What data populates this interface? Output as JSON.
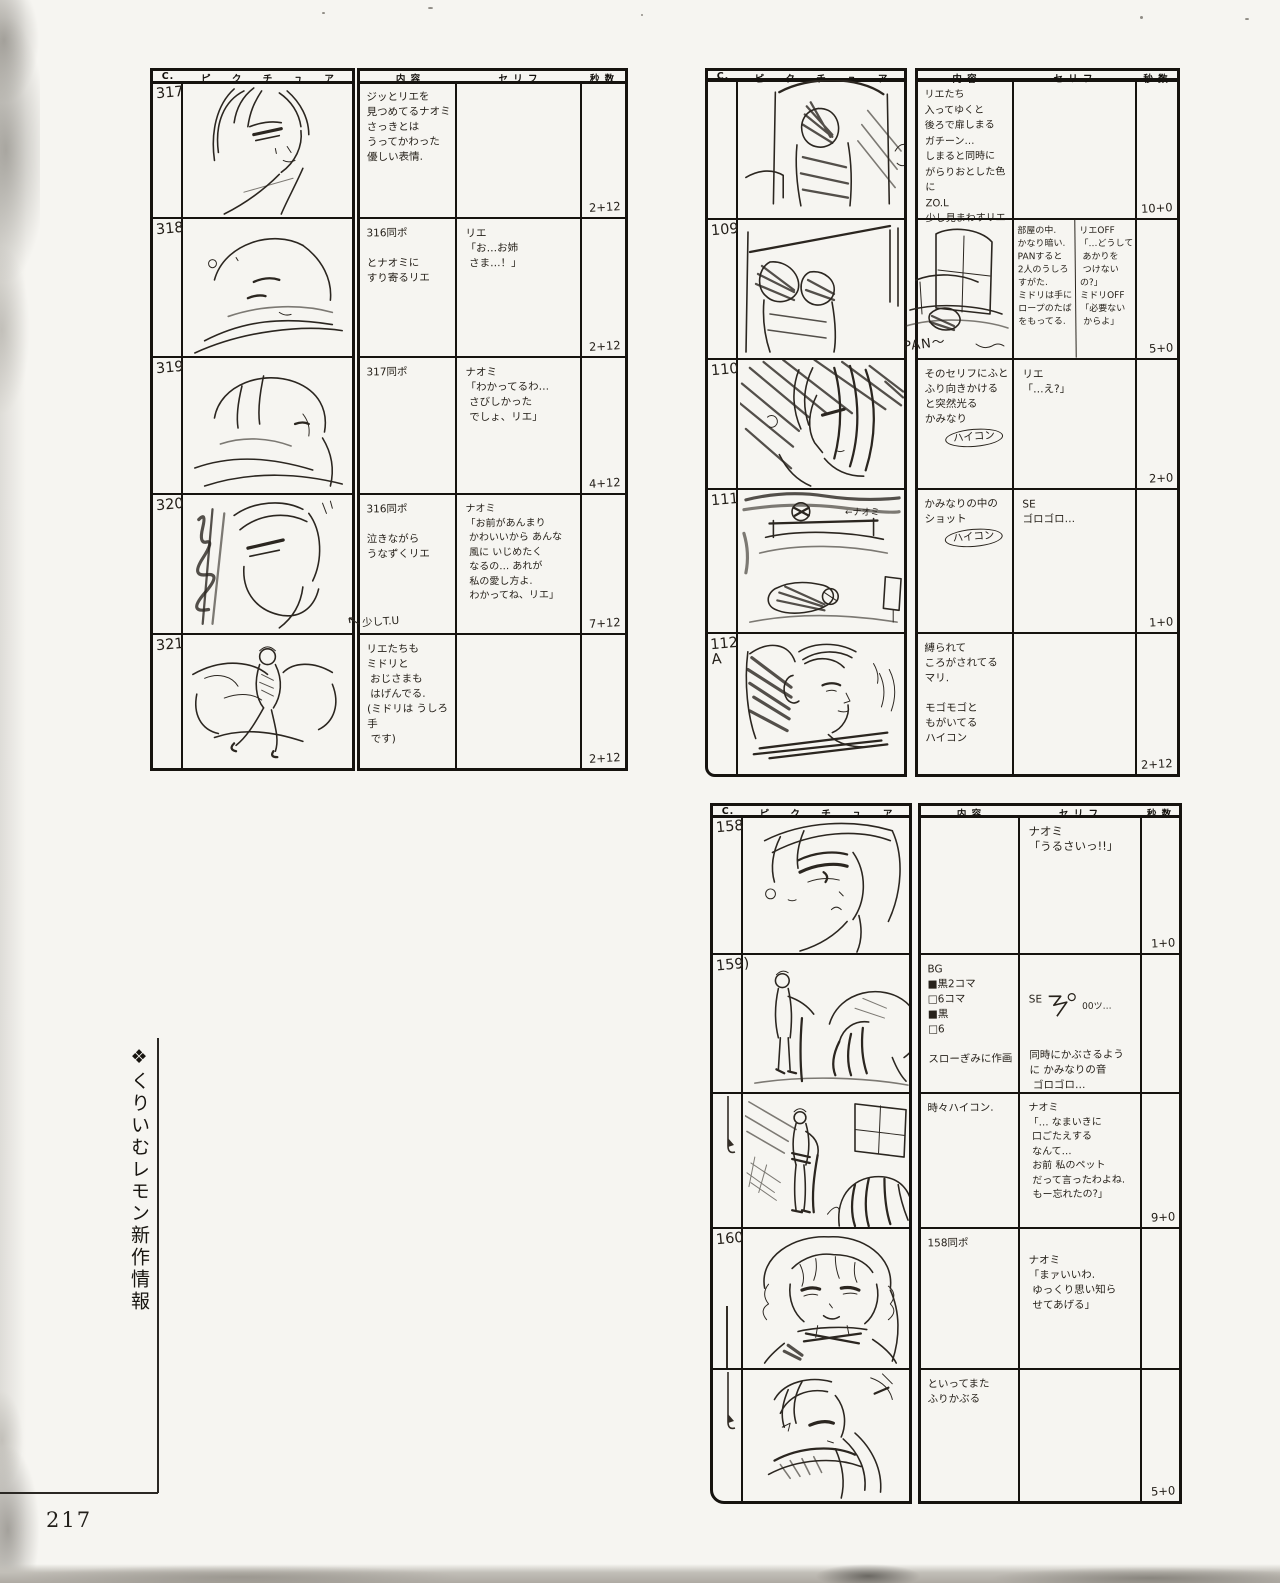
{
  "page": {
    "number": "217",
    "side_caption": "❖くりいむレモン新作情報"
  },
  "form": {
    "headers": {
      "cut": "C.",
      "picture": "ピ ク チ ュ ア",
      "content": "内  容",
      "dialogue": "セ リ フ",
      "seconds": "秒 数"
    }
  },
  "tables": [
    {
      "rows": [
        {
          "cut": "317",
          "content": "ジッとリエを\n見つめてるナオミ\nさっきとは\nうってかわった\n優しい表情.",
          "dialogue": "",
          "seconds": "2+12"
        },
        {
          "cut": "318",
          "content": "316同ポ\n\nとナオミに\nすり寄るリエ",
          "dialogue": "リエ\n「お…お姉\n さま…！」",
          "seconds": "2+12"
        },
        {
          "cut": "319",
          "content": "317同ポ",
          "dialogue": "ナオミ\n「わかってるわ…\n さびしかった\n でしょ、リエ」",
          "seconds": "4+12"
        },
        {
          "cut": "320",
          "content": "316同ポ\n\n泣きながら\nうなずくリエ",
          "note": "少しT.U",
          "dialogue": "ナオミ\n「お前があんまり\n かわいいから あんな\n 風に いじめたく\n なるの… あれが\n 私の愛し方よ.\n わかってね、リエ」",
          "seconds": "7+12"
        },
        {
          "cut": "321",
          "content": "リエたちも\nミドリと\n おじさまも\n はげんでる.\n(ミドリは うしろ手\n です)",
          "dialogue": "",
          "seconds": "2+12"
        }
      ]
    },
    {
      "rows": [
        {
          "cut": "",
          "content": "リエたち\n入ってゆくと\n後ろで扉しまる\nガチーン…\nしまると同時に\nがらりおとした色に\nZO.L\n少し見まわすリエ",
          "dialogue": "",
          "seconds": "10+0"
        },
        {
          "cut": "109",
          "content": "部屋の中.\nかなり暗い.\nPANすると\n2人のうしろ\nすがた.\nミドリは手に\nロープのたば\nをもってる.",
          "pan_label": "PAN〜",
          "dialogue": "リエOFF\n「…どうして\n あかりを\n つけないの?」\nミドリOFF\n「必要ない\n からよ」",
          "seconds": "5+0"
        },
        {
          "cut": "110",
          "content": "そのセリフにふと\nふり向きかける\nと突然光る\nかみなり",
          "circled": "ハイコン",
          "dialogue": "リエ\n「…え?」",
          "seconds": "2+0"
        },
        {
          "cut": "111",
          "content": "かみなりの中の\nショット",
          "circled": "ハイコン",
          "picture_note": "←ナオミ",
          "dialogue": "SE\nゴロゴロ…",
          "seconds": "1+0"
        },
        {
          "cut": "112\nA",
          "content": "縛られて\nころがされてる\nマリ.\n\nモゴモゴと\nもがいてる\nハイコン",
          "dialogue": "",
          "seconds": "2+12"
        }
      ]
    },
    {
      "rows": [
        {
          "cut": "158",
          "content": "",
          "dialogue": "ナオミ\n「うるさいっ!!」",
          "seconds": "1+0"
        },
        {
          "cut": "159)",
          "content": "BG\n■黒2コマ\n□6コマ\n■黒\n□6\n\nスローぎみに作画",
          "se_label": "SE",
          "se_note": "00ツ…",
          "dialogue": "同時にかぶさるよう\nに かみなりの音\n ゴロゴロ…",
          "seconds": ""
        },
        {
          "cut": "",
          "content": "時々ハイコン.",
          "dialogue": "ナオミ\n「… なまいきに\n 口ごたえする\n なんて…\n お前 私のペット\n だって言ったわよね.\n もー忘れたの?」",
          "seconds": "9+0"
        },
        {
          "cut": "160",
          "content": "158同ポ",
          "dialogue": "ナオミ\n「まァいいわ.\n ゆっくり思い知ら\n せてあげる」",
          "seconds": ""
        },
        {
          "cut": "",
          "content": "といってまた\nふりかぶる",
          "dialogue": "",
          "seconds": "5+0"
        }
      ]
    }
  ]
}
